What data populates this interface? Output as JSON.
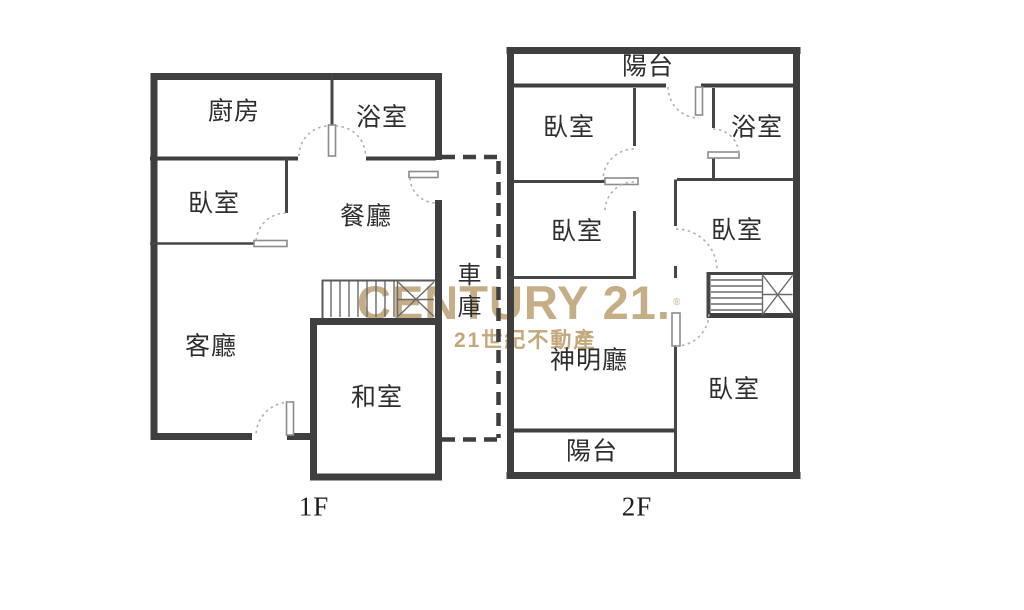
{
  "floor1": {
    "caption": "1F",
    "rooms": {
      "kitchen": "廚房",
      "bath": "浴室",
      "bedroom": "臥室",
      "dining": "餐廳",
      "living": "客廳",
      "tatami": "和室",
      "garage": "車庫"
    }
  },
  "floor2": {
    "caption": "2F",
    "rooms": {
      "balcony_top": "陽台",
      "bedroom_a": "臥室",
      "bath": "浴室",
      "bedroom_b": "臥室",
      "bedroom_c": "臥室",
      "shrine": "神明廳",
      "bedroom_d": "臥室",
      "balcony_bottom": "陽台"
    }
  },
  "watermark": {
    "brand_text": "CENTURY 21.",
    "registered": "®",
    "tagline": "21世紀不動產",
    "brand_color": "#C5AE85",
    "tagline_color": "#C4A87A"
  },
  "colors": {
    "background": "#FFFFFF",
    "wall": "#3F3F3F",
    "stair_line": "#6A6A6A",
    "door_leaf": "#8C8C8C",
    "door_arc": "#B0B0B0",
    "label_text": "#2E2E2E"
  }
}
